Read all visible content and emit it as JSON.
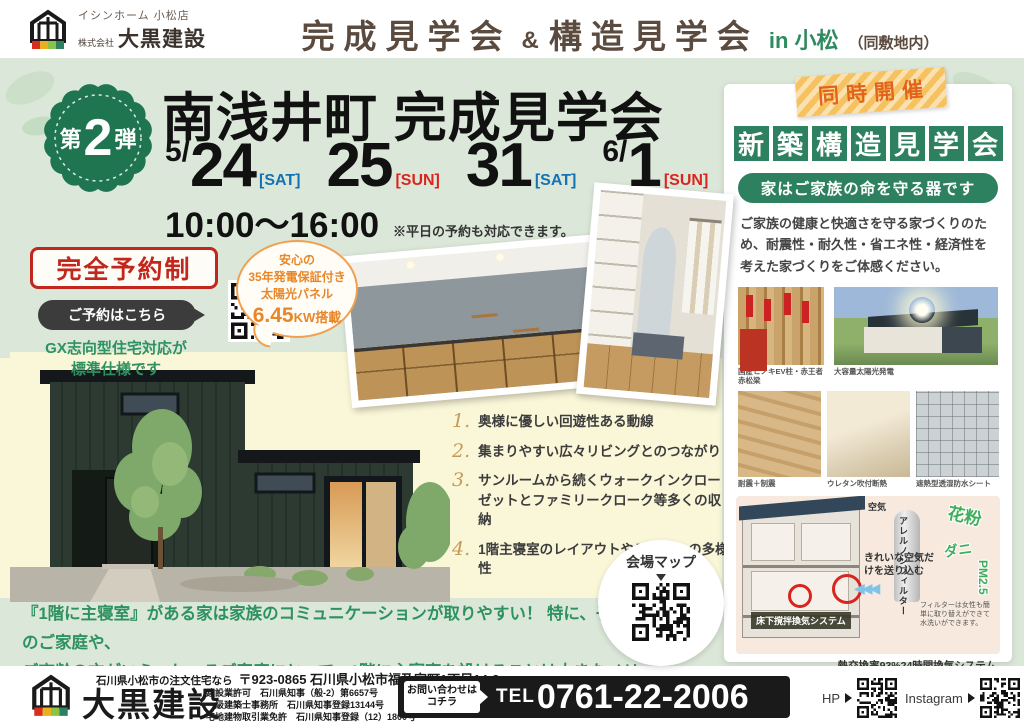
{
  "header": {
    "store": "イシンホーム 小松店",
    "company_prefix": "株式会社",
    "company": "大黒建設",
    "title_left": "完成見学会",
    "amp": "&",
    "title_right": "構造見学会",
    "location": "in 小松",
    "location_note": "（同敷地内）"
  },
  "main": {
    "badge": {
      "first": "第",
      "num": "2",
      "last": "弾"
    },
    "title": "南浅井町 完成見学会",
    "dates": [
      {
        "prefix": "5/",
        "day": "24",
        "dow": "[SAT]"
      },
      {
        "prefix": "",
        "day": "25",
        "dow": "[SUN]"
      },
      {
        "prefix": "",
        "day": "31",
        "dow": "[SAT]"
      },
      {
        "prefix": "6/",
        "day": "1",
        "dow": "[SUN]"
      }
    ],
    "time": "10:00〜16:00",
    "time_note": "※平日の予約も対応できます。",
    "reserve_label": "完全予約制",
    "reserve_cta": "ご予約はこちら",
    "gx_note_1": "GX志向型住宅対応が",
    "gx_note_2": "標準仕様です",
    "solar_bubble": {
      "line1": "安心の",
      "line2": "35年発電保証付き",
      "line3": "太陽光パネル",
      "value": "6.45",
      "unit": "KW搭載"
    },
    "features": [
      {
        "num": "1.",
        "text": "奥様に優しい回遊性ある動線"
      },
      {
        "num": "2.",
        "text": "集まりやすい広々リビングとのつながり"
      },
      {
        "num": "3.",
        "text": "サンルームから続くウォークインクローゼットとファミリークローク等多くの収納"
      },
      {
        "num": "4.",
        "text": "1階主寝室のレイアウトやデザインの多様性"
      }
    ],
    "map_label": "会場マップ",
    "bottom_note_1": "『1階に主寝室』がある家は家族のコミュニケーションが取りやすい！ 特に、子育て中のご家庭や、",
    "bottom_note_2": "ご高齢の方がいらっしゃるご家庭にとって、1階に主寝室を設けることは大きなメリットとなります。"
  },
  "side_panel": {
    "tape": "同時開催",
    "title_chars": [
      "新",
      "築",
      "構",
      "造",
      "見",
      "学",
      "会"
    ],
    "subtitle": "家はご家族の命を守る器です",
    "description": "ご家族の健康と快適さを守る家づくりのため、耐震性・耐久性・省エネ性・経済性を考えた家づくりをご体感ください。",
    "captions": [
      "国産ヒノキEV柱・赤王者赤松梁",
      "大容量太陽光発電",
      "耐震＋制震",
      "ウレタン吹付断熱",
      "遮熱型透湿防水シート"
    ],
    "diagram": {
      "air_label": "空気",
      "filter_vertical": "アレルノンフィルター",
      "pollen": "花粉",
      "mite": "ダニ",
      "pm25": "PM2.5",
      "clean_air": "きれいな空気だけを送り込む",
      "arrows": "◀◀◀",
      "underfloor_label": "床下撹拌換気システム",
      "filter_note": "フィルターは女性も簡単に取り替えができて水洗いができます。",
      "caption": "熱交換率93%24時間換気システム"
    }
  },
  "footer": {
    "company": "大黒建設",
    "tagline": "石川県小松市の注文住宅なら",
    "address": "〒923-0865 石川県小松市福乃宮町1丁目14-2",
    "licenses": [
      "建設業許可　石川県知事（般-2）第6657号",
      "一級建築士事務所　石川県知事登録13144号",
      "宅地建物取引業免許　石川県知事登録（12）1800号"
    ],
    "contact_cta_1": "お問い合わせは",
    "contact_cta_2": "コチラ",
    "tel_label": "TEL",
    "tel": "0761-22-2006",
    "hp_label": "HP",
    "instagram_label": "Instagram"
  },
  "colors": {
    "bg_green": "#dbe7d8",
    "cream": "#faf6d8",
    "brand_green": "#2e8160",
    "badge_green": "#1e7550",
    "red": "#d9251f",
    "blue": "#1273b5",
    "orange": "#ef8c1f",
    "brown_text": "#5b4a3e"
  }
}
